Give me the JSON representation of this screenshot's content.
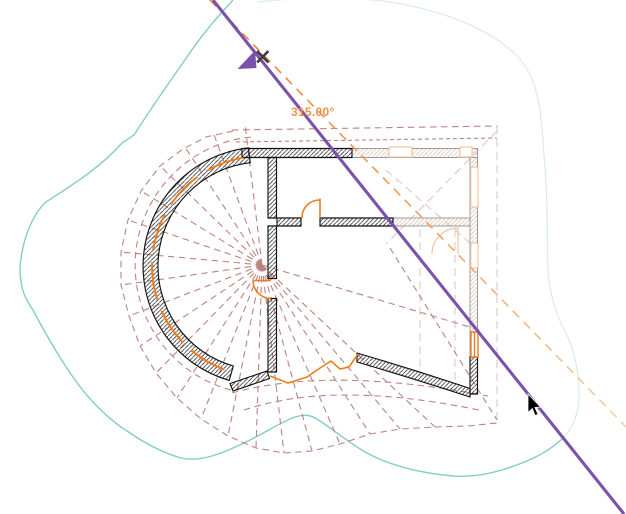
{
  "canvas": {
    "angle_readout": {
      "value": "315.00°"
    },
    "colors": {
      "purple": "#7a52ab",
      "orange": "#ee7d1f",
      "label_orange": "#f0924e",
      "rose": "#bd837f",
      "rose_pale": "#e4c5c2",
      "teal": "#82cec4",
      "teal_pale": "#d8ece8",
      "halftone": "#9c9c9c",
      "peach": "#f2c4a0",
      "hatch": "#2e2e2e",
      "hatch_pale": "#dcc0b2",
      "ref_orange_start": "#ed7f2e",
      "ref_orange_end": "#f6cda9",
      "cursor_black": "#000000"
    },
    "icons": {
      "rotation_arrowhead": "rotation-arrowhead-icon",
      "snap_close": "snap-x-icon",
      "mouse_cursor": "cursor-arrow-icon"
    },
    "elements": [
      "site-contour-outline",
      "roof-overhang-dashed-fan",
      "curved-glazed-wall-building",
      "halftone-ghost-wing",
      "rotation-reference-ray",
      "rotation-angle-ray",
      "angle-readout",
      "mouse-cursor"
    ]
  }
}
